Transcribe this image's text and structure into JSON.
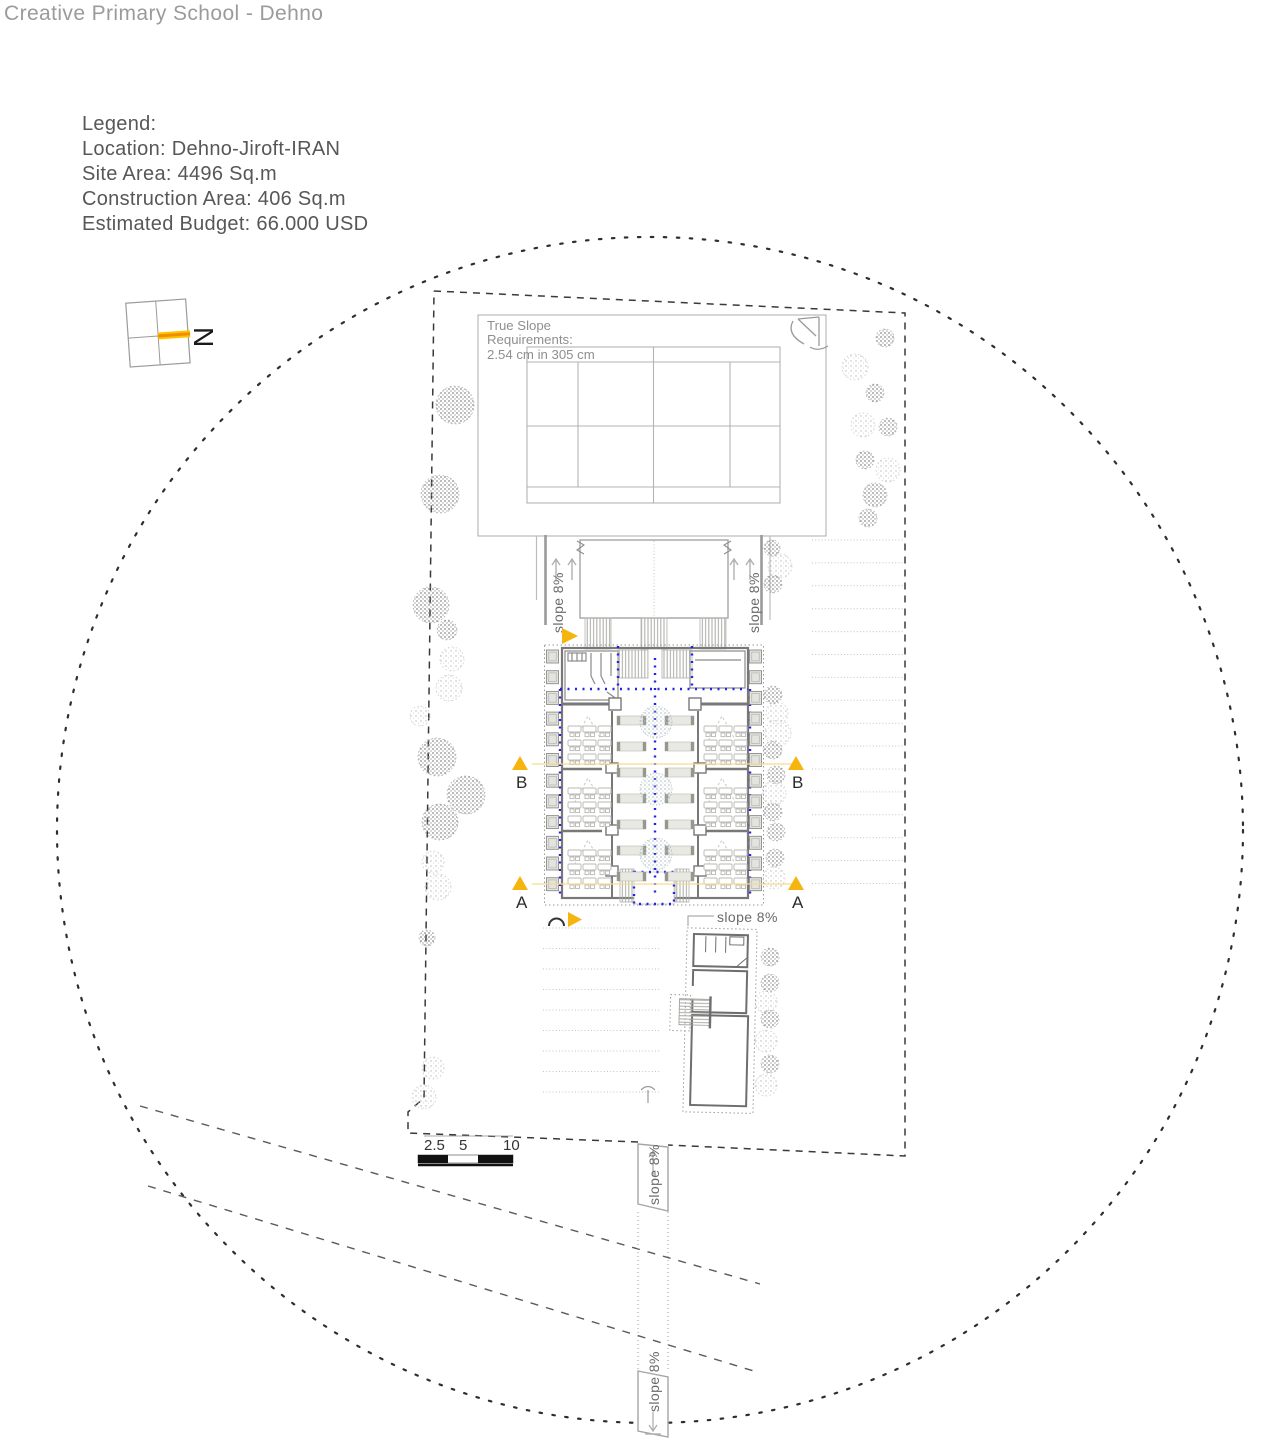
{
  "title": "Creative Primary School - Dehno",
  "legend": {
    "heading": "Legend:",
    "location": "Location: Dehno-Jiroft-IRAN",
    "site_area": "Site Area: 4496 Sq.m",
    "construction_area": "Construction Area: 406 Sq.m",
    "budget": "Estimated Budget: 66.000 USD"
  },
  "north_label": "N",
  "court_note": {
    "line1": "True Slope",
    "line2": "Requirements:",
    "line3": "2.54 cm in 305 cm"
  },
  "slope_labels": {
    "court_left": "slope 8%",
    "court_right": "slope 8%",
    "south_wing": "slope 8%",
    "ramp_upper": "slope 8%",
    "ramp_lower": "slope 8%"
  },
  "section_markers": {
    "b_left": "B",
    "b_right": "B",
    "a_left": "A",
    "a_right": "A"
  },
  "scale_bar": {
    "tick_2_5": "2.5",
    "tick_5": "5",
    "tick_10": "10"
  },
  "colors": {
    "accent_yellow": "#f6b40e",
    "north_orange": "#ef8f00",
    "circulation_blue": "#2323e0"
  }
}
